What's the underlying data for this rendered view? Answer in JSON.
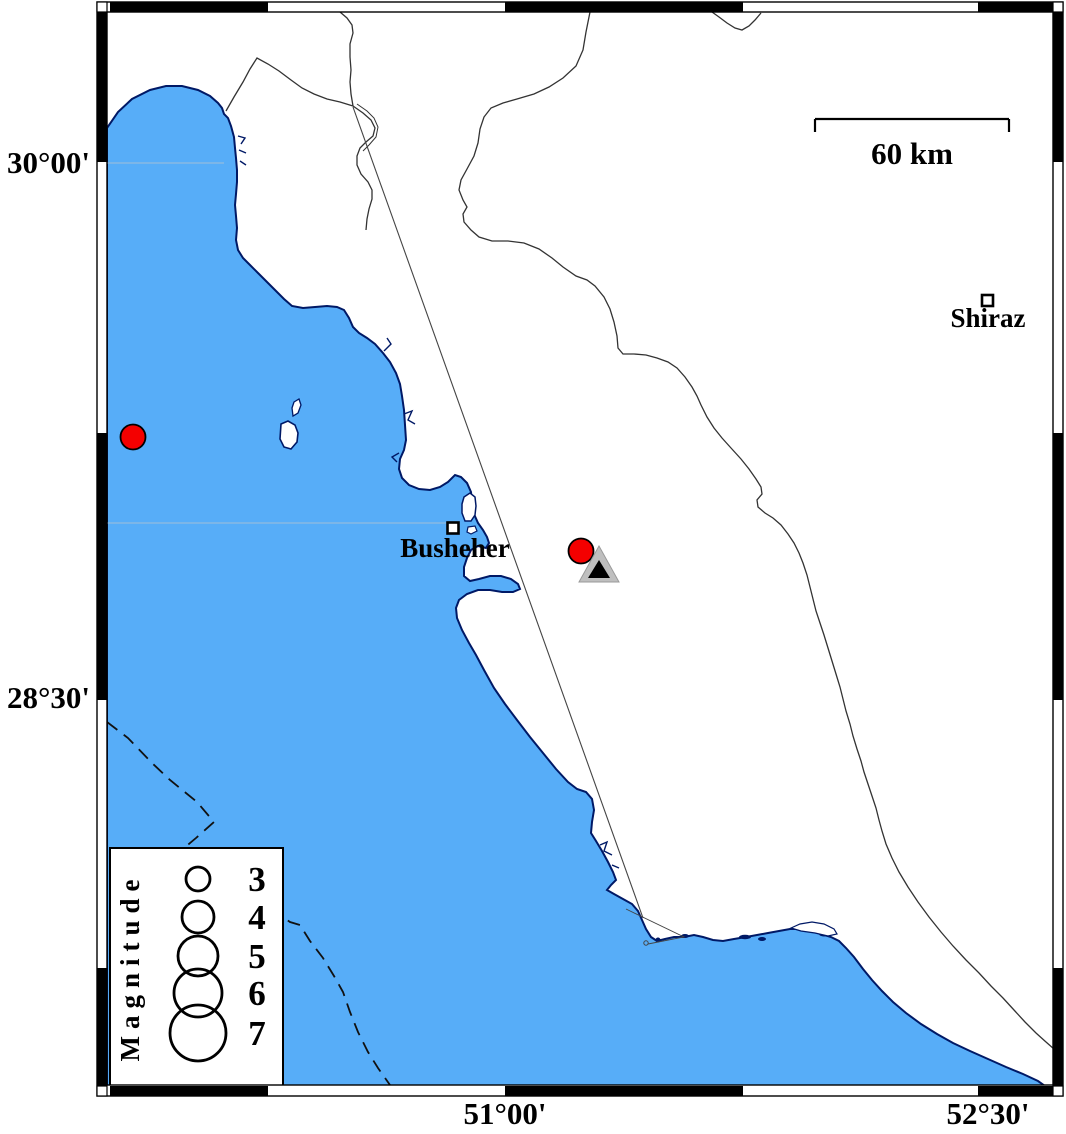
{
  "axis": {
    "left_labels": [
      {
        "text": "30°00'"
      },
      {
        "text": "28°30'"
      }
    ],
    "bottom_labels": [
      {
        "text": "51°00'"
      },
      {
        "text": "52°30'"
      }
    ]
  },
  "scale_bar": {
    "label": "60 km",
    "length_km": 60
  },
  "cities": [
    {
      "name": "Busheher",
      "marker": "open-square",
      "x": 453,
      "y": 528
    },
    {
      "name": "Shiraz",
      "marker": "open-square",
      "x": 987,
      "y": 301
    }
  ],
  "legend": {
    "title": "Magnitude",
    "items": [
      {
        "magnitude": "3"
      },
      {
        "magnitude": "4"
      },
      {
        "magnitude": "5"
      },
      {
        "magnitude": "6"
      },
      {
        "magnitude": "7"
      }
    ]
  },
  "markers": {
    "earthquakes": [
      {
        "x": 133,
        "y": 437,
        "approx_magnitude": 3.5
      },
      {
        "x": 581,
        "y": 551,
        "approx_magnitude": 3.5
      }
    ],
    "station": {
      "x": 599,
      "y": 568,
      "symbol": "triangle"
    }
  },
  "colors": {
    "sea": "#57ADF8",
    "coast": "#001966",
    "earthquake": "#F40000",
    "station_outer": "#BFBFBF",
    "station_inner": "#000000",
    "grid_faint": "#93BCDF",
    "border_line": "#333333"
  }
}
